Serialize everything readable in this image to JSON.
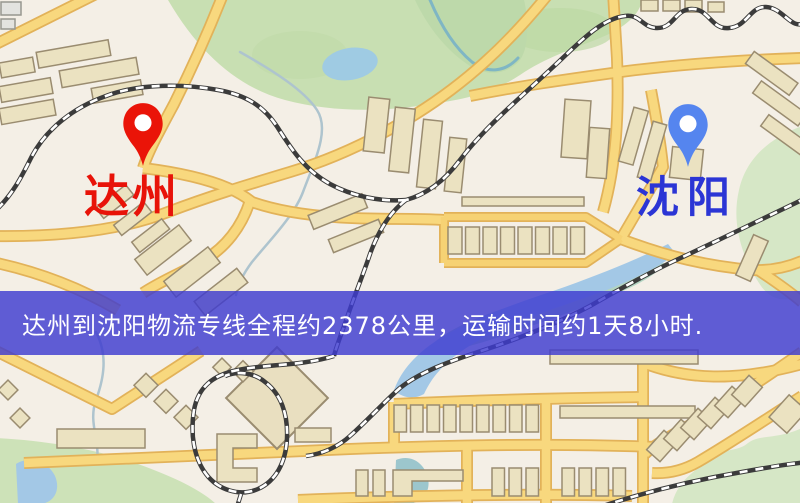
{
  "map": {
    "origin": {
      "label": "达州",
      "pin_color": "#ea1408",
      "label_color": "#e81309"
    },
    "destination": {
      "label": "沈阳",
      "pin_color": "#5585ef",
      "label_color": "#2b35d5"
    },
    "colors": {
      "background": "#f4efe6",
      "road_fill": "#f8d87e",
      "road_casing": "#e2b259",
      "park": "#c8dfb2",
      "water": "#a3c8e6",
      "building_fill": "#ebe2c1",
      "building_stroke": "#9a8c70",
      "railway": "#3b3b3b"
    }
  },
  "banner": {
    "text": "达州到沈阳物流专线全程约2378公里，运输时间约1天8小时.",
    "background_color": "#3e3cd0",
    "text_color": "#ffffff"
  },
  "route": {
    "origin": "达州",
    "destination": "沈阳",
    "distance": "约2378公里",
    "duration": "约1天8小时"
  }
}
